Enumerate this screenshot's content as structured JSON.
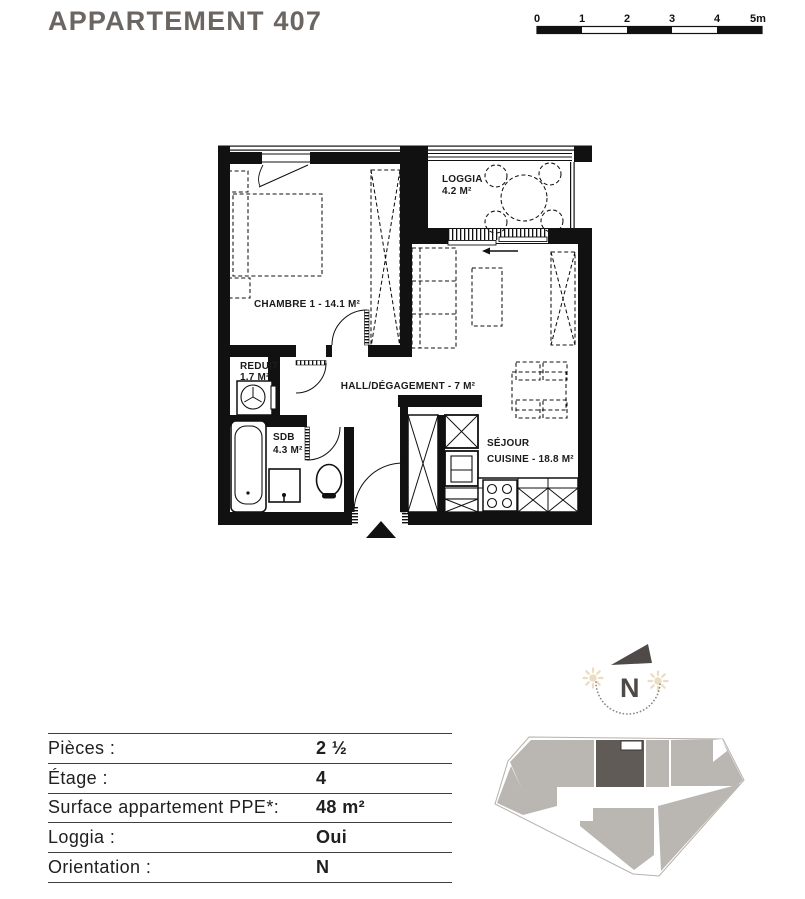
{
  "title": "APPARTEMENT 407",
  "scale": {
    "l0": "0",
    "l1": "1",
    "l2": "2",
    "l3": "3",
    "l4": "4",
    "l5": "5m"
  },
  "plan": {
    "loggia_name": "LOGGIA",
    "loggia_area": "4.2 M²",
    "chambre_label": "CHAMBRE 1 - 14.1 M²",
    "reduit_name": "REDUIT",
    "reduit_area": "1.7 M²",
    "hall_label": "HALL/DÉGAGEMENT - 7 M²",
    "sdb_name": "SDB",
    "sdb_area": "4.3 M²",
    "sejour_name": "SÉJOUR",
    "sejour_area": "CUISINE - 18.8 M²"
  },
  "compass": {
    "north_label": "N"
  },
  "info_table": {
    "rows": [
      {
        "label": "Pièces :",
        "value": "2 ½"
      },
      {
        "label": "Étage :",
        "value": "4"
      },
      {
        "label": "Surface appartement PPE*:",
        "value": "48 m²"
      },
      {
        "label": "Loggia :",
        "value": "Oui"
      },
      {
        "label": "Orientation :",
        "value": "N"
      }
    ]
  },
  "colors": {
    "plan_black": "#111111",
    "title_gray": "#6b6661",
    "building_gray": "#bab6b2",
    "highlight_unit_dark": "#605b57",
    "sun_beige": "#ecdcc1"
  }
}
